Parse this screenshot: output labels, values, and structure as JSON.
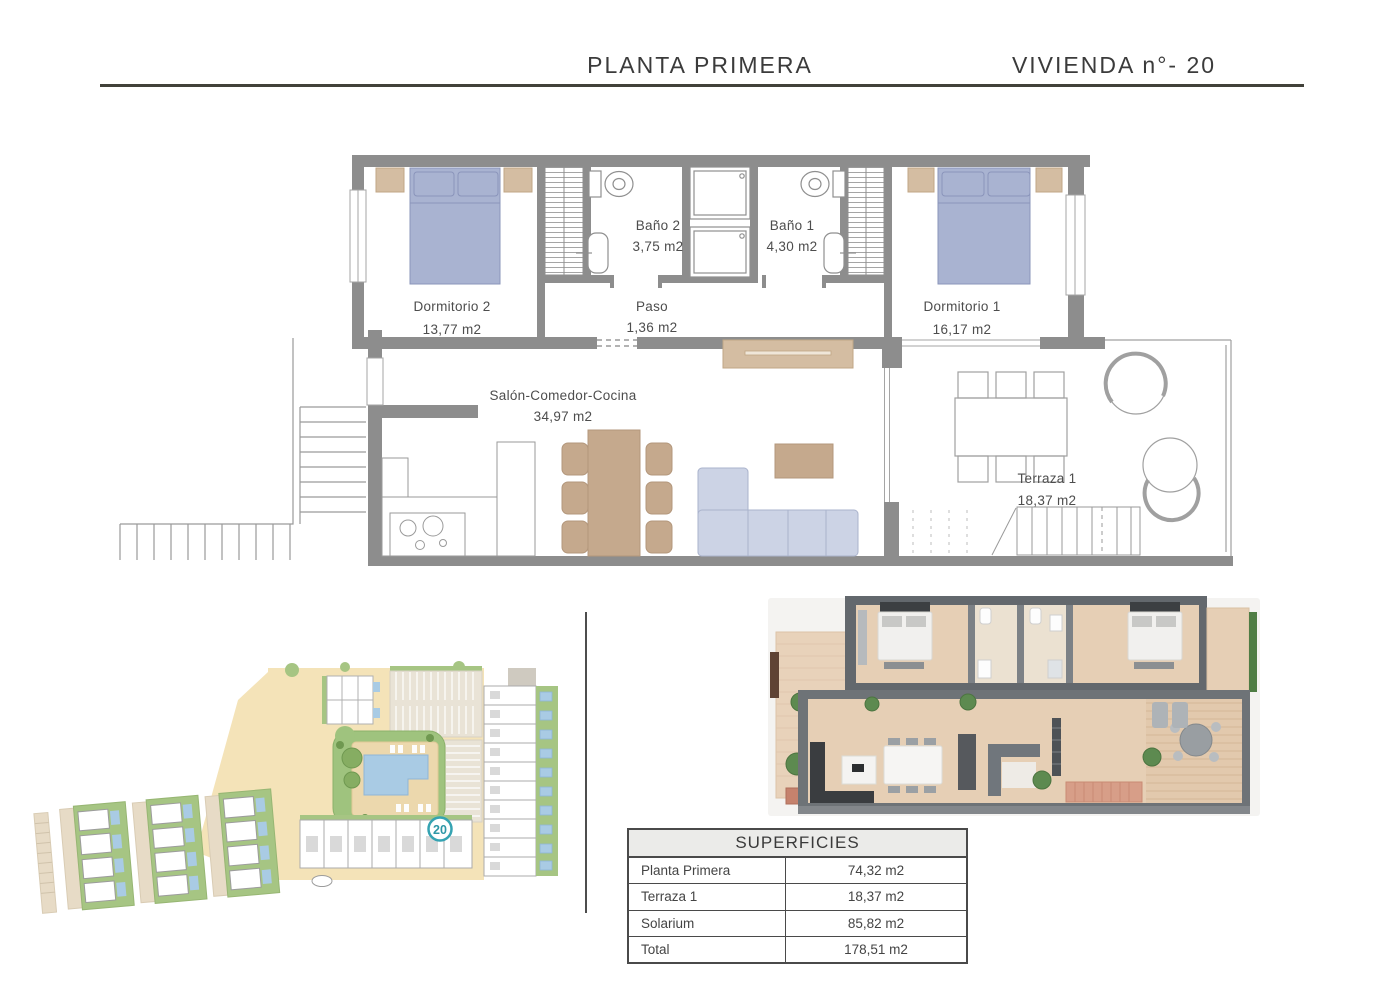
{
  "header": {
    "plan_title": "PLANTA PRIMERA",
    "unit_title": "VIVIENDA n°- 20"
  },
  "floorplan": {
    "rooms": {
      "dormitorio2": {
        "name": "Dormitorio 2",
        "area": "13,77 m2"
      },
      "bano2": {
        "name": "Baño 2",
        "area": "3,75 m2"
      },
      "paso": {
        "name": "Paso",
        "area": "1,36 m2"
      },
      "bano1": {
        "name": "Baño 1",
        "area": "4,30 m2"
      },
      "dormitorio1": {
        "name": "Dormitorio 1",
        "area": "16,17 m2"
      },
      "salon": {
        "name": "Salón-Comedor-Cocina",
        "area": "34,97 m2"
      },
      "terraza": {
        "name": "Terraza 1",
        "area": "18,37 m2"
      }
    }
  },
  "siteplan": {
    "unit_badge": "20"
  },
  "surfaces_table": {
    "title": "SUPERFICIES",
    "rows": [
      {
        "label": "Planta Primera",
        "value": "74,32 m2"
      },
      {
        "label": "Terraza 1",
        "value": "18,37 m2"
      },
      {
        "label": "Solarium",
        "value": "85,82 m2"
      },
      {
        "label": "Total",
        "value": "178,51 m2"
      }
    ]
  },
  "colors": {
    "accent_teal": "#2d97a6",
    "wall_gray": "#8d8d8d",
    "furniture_blue": "#a9b3d1",
    "furniture_tan": "#d4bda2",
    "wood": "#c5a98d",
    "sofa_lavender": "#ccd3e5",
    "site_green": "#a6c583",
    "site_road": "#f4e3b8",
    "pool_blue": "#a9cbe4"
  }
}
